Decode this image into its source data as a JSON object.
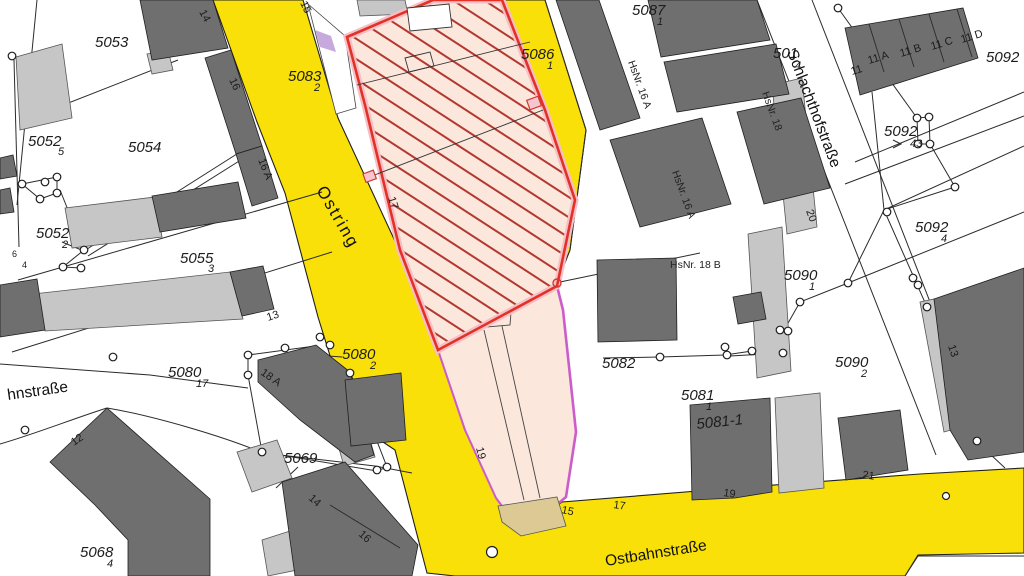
{
  "map": {
    "type": "cadastral-map",
    "streets": {
      "ostring": "Ostring",
      "schlachthofstrasse": "Schlachthofstraße",
      "ostbahnstrasse": "Ostbahnstraße",
      "left_street_partial": "hnstraße"
    },
    "parcels": {
      "p5053": "5053",
      "p5054": "5054",
      "p5052a": "5052",
      "p5052a_s": "5",
      "p5052b": "5052",
      "p5052b_s": "2",
      "p5055": "5055",
      "p5055_s": "3",
      "p5080a": "5080",
      "p5080a_s": "17",
      "p5080b": "5080",
      "p5080b_s": "2",
      "p5069": "5069",
      "p5068": "5068",
      "p5068_s": "4",
      "p5083": "5083",
      "p5083_s": "2",
      "p5086": "5086",
      "p5086_s": "1",
      "p5087": "5087",
      "p5087_s": "1",
      "p501": "501",
      "p501_s": "4",
      "p5092a": "5092",
      "p5092b": "5092",
      "p5092b_s": "43",
      "p5092c": "5092",
      "p5092c_s": "4",
      "p5090a": "5090",
      "p5090a_s": "1",
      "p5090b": "5090",
      "p5090b_s": "2",
      "p5082": "5082",
      "p5081": "5081",
      "p5081_s": "1",
      "p5081x": "5081-1",
      "frag6": "6",
      "frag4": "4"
    },
    "house_numbers": {
      "h14a": "14",
      "h16a": "16",
      "h16Aa": "16 A",
      "h15top": "15",
      "h17hatch": "17",
      "h13": "13",
      "h18A": "18 A",
      "h12": "12",
      "h14b": "14",
      "h16b": "16",
      "h19pink": "19",
      "h15b": "15",
      "h17b": "17",
      "h19b": "19",
      "h21": "21",
      "h20": "20",
      "h13r": "13",
      "r11": "11",
      "r11a": "11 A",
      "r11b": "11 B",
      "r11c": "11 C",
      "r11d": "11 D"
    },
    "hsnr_labels": {
      "hs16A_1": "HsNr. 16 A",
      "hs16A_2": "HsNr. 16 A",
      "hs18": "HsNr. 18",
      "hs18B": "HsNr. 18 B"
    },
    "colors": {
      "street_yellow": "#f8e008",
      "parcel_peach": "#fbe7dc",
      "hatch_red": "#b23830",
      "border_red": "#e23228",
      "border_halo": "#f6bfc6",
      "border_magenta": "#cb5ccb",
      "lavender": "#c7a9dd",
      "building_dark": "#6f6f6f",
      "building_light": "#c6c6c6",
      "tan_island": "#dcc993",
      "line_black": "#1f1f1f"
    }
  }
}
